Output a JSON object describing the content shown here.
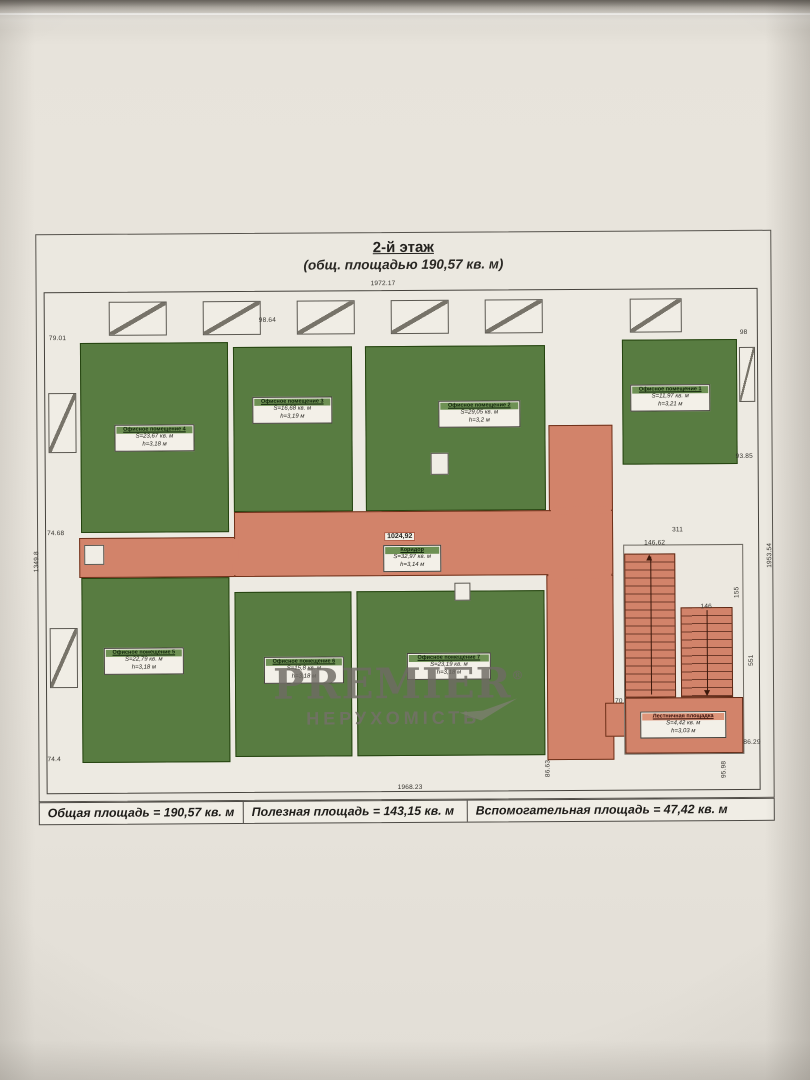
{
  "title": {
    "floor": "2-й этаж",
    "subtitle": "(общ. площадью 190,57 кв. м)"
  },
  "rooms": [
    {
      "name": "Офисное помещение 4",
      "area": "S=23,67 кв. м",
      "height": "h=3,18 м"
    },
    {
      "name": "Офисное помещение 3",
      "area": "S=16,68 кв. м",
      "height": "h=3,19 м"
    },
    {
      "name": "Офисное помещение 2",
      "area": "S=29,05 кв. м",
      "height": "h=3,2 м"
    },
    {
      "name": "Офисное помещение 1",
      "area": "S=11,97 кв. м",
      "height": "h=3,21 м"
    },
    {
      "name": "Офисное помещение 5",
      "area": "S=22,79 кв. м",
      "height": "h=3,18 м"
    },
    {
      "name": "Офисное помещение 6",
      "area": "S=15,8 кв. м",
      "height": "h=3,18 м"
    },
    {
      "name": "Офисное помещение 7",
      "area": "S=23,19 кв. м",
      "height": "h=3,18 м"
    }
  ],
  "corridor": {
    "dim": "1024,92",
    "name": "Коридор",
    "area": "S=32,97 кв. м",
    "height": "h=3,14 м"
  },
  "stairs": {
    "name": "Лестничная площадка",
    "area": "S=4,42 кв. м",
    "height": "h=3,03 м"
  },
  "watermark": {
    "brand": "PREMIER",
    "reg": "®",
    "tagline": "НЕРУХОМІСТЬ"
  },
  "footer": {
    "total": "Общая площадь = 190,57 кв. м",
    "useful": "Полезная площадь = 143,15 кв. м",
    "auxiliary": "Вспомогательная площадь = 47,42 кв. м"
  },
  "dims": [
    "1972.17",
    "98.64",
    "79.01",
    "74.68",
    "74.4",
    "1349.8",
    "1953.54",
    "93.85",
    "98",
    "311",
    "146,62",
    "146",
    "155",
    "551",
    "70",
    "1968.23",
    "86.63",
    "95.98",
    "86.29"
  ],
  "colors": {
    "room_green": "#587c41",
    "corridor_salmon": "#d2836a",
    "paper": "#e7e3db"
  }
}
